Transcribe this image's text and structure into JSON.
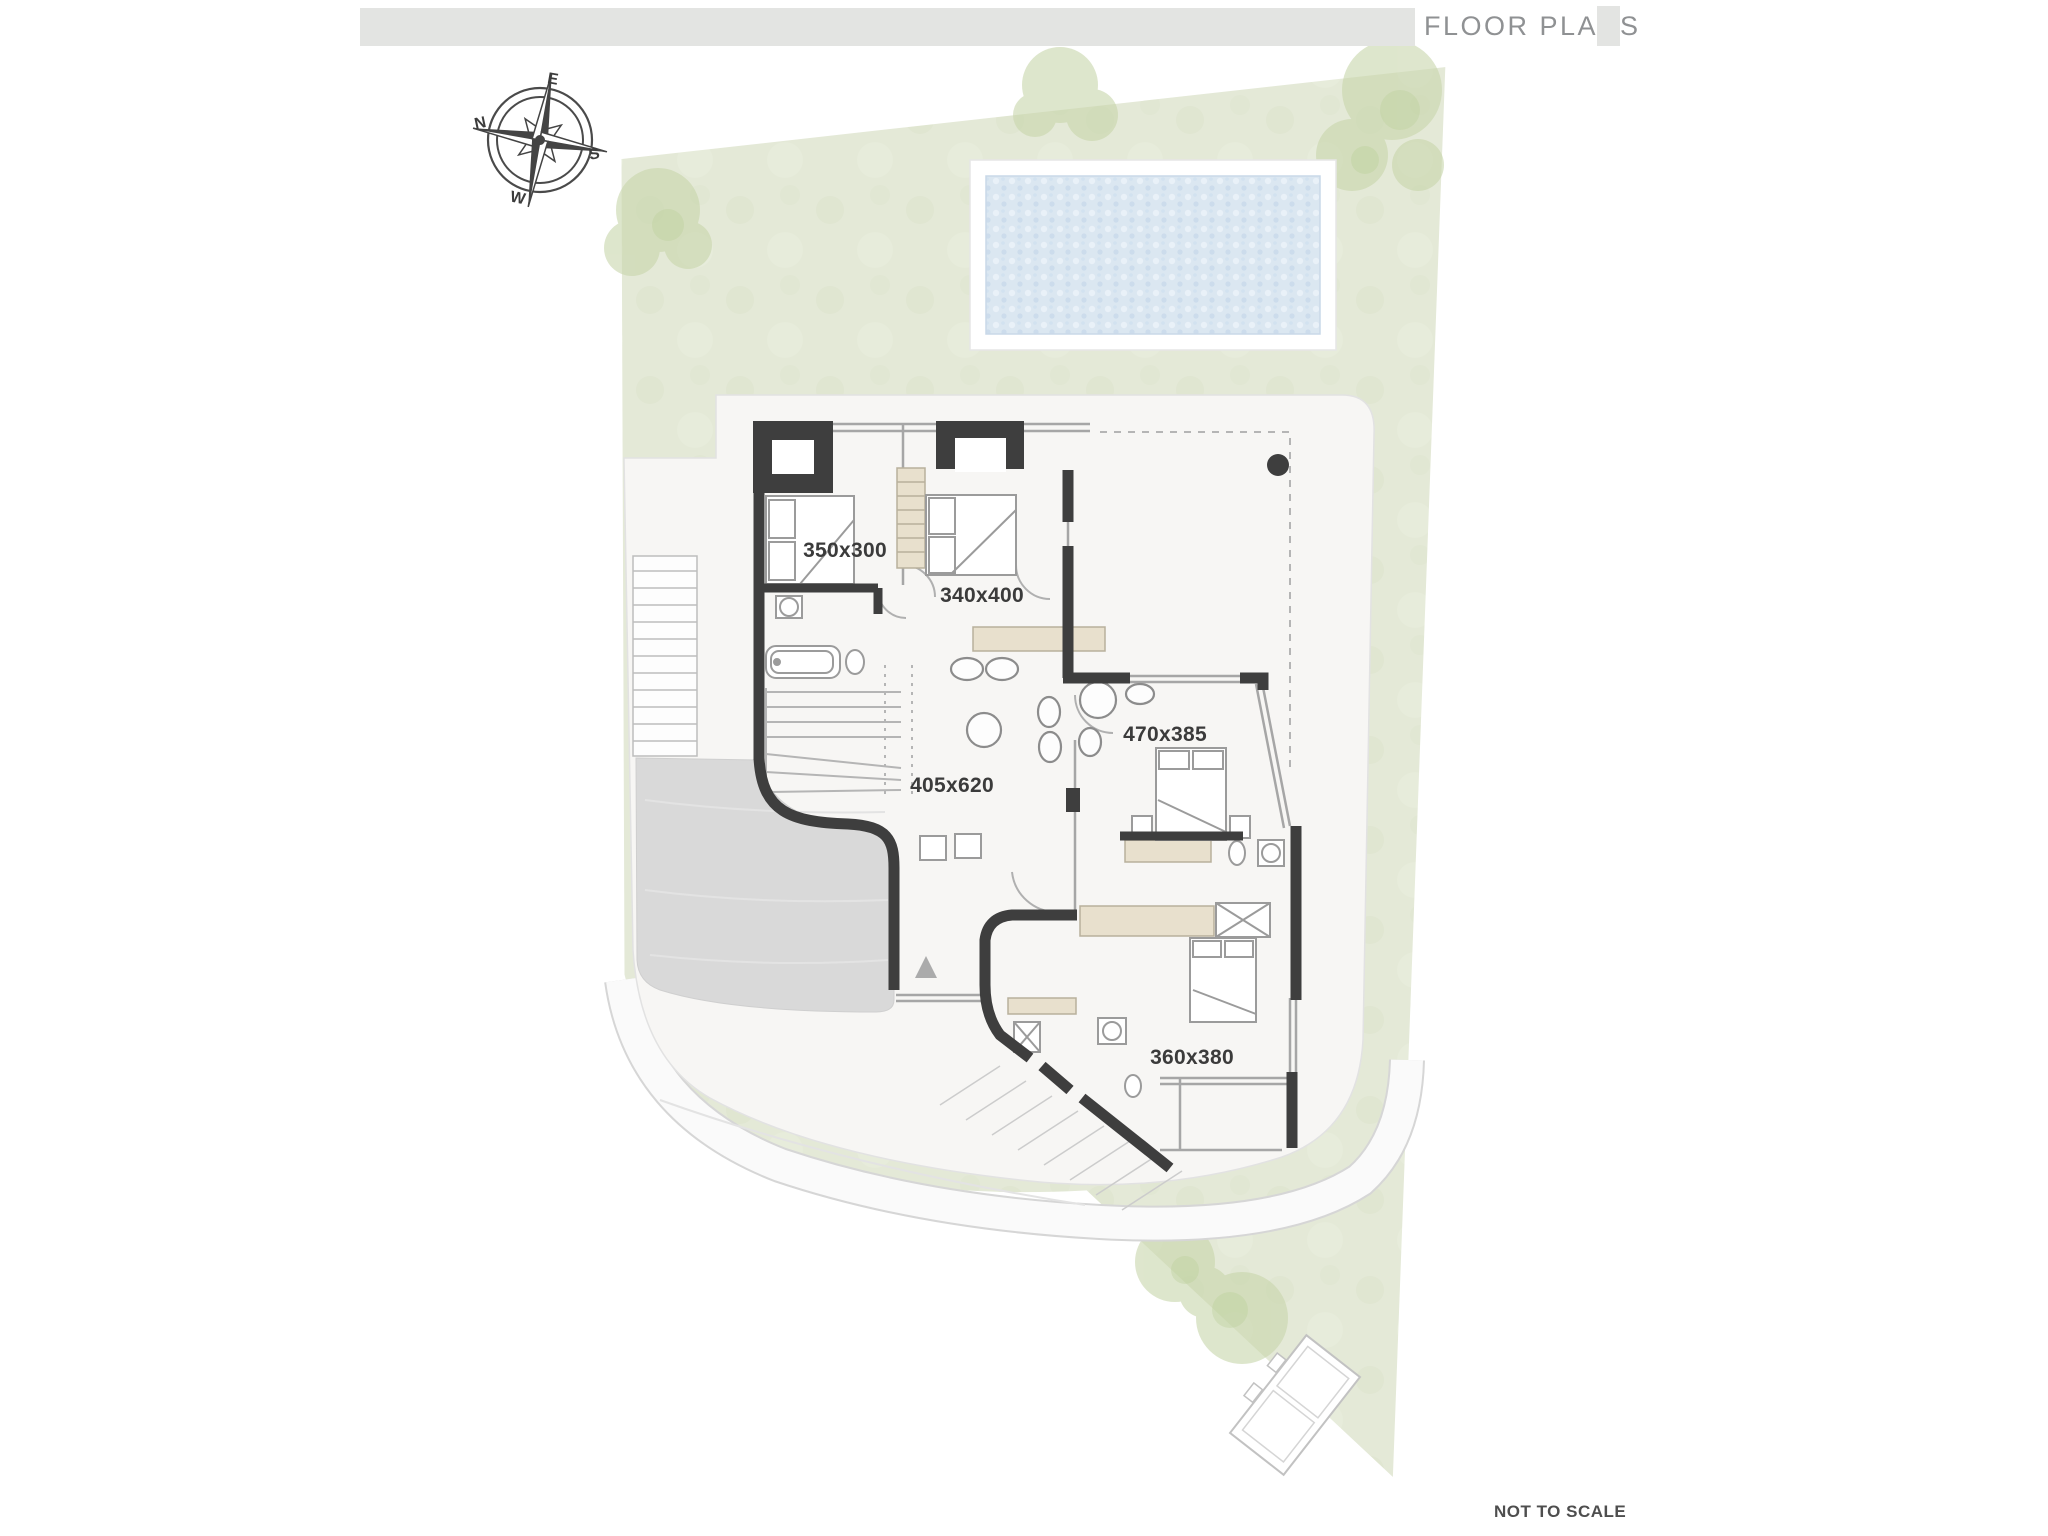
{
  "header": {
    "title": "FLOOR PLANS"
  },
  "footer": {
    "note": "NOT TO SCALE"
  },
  "compass": {
    "north": "N",
    "east": "E",
    "south": "S",
    "west": "W"
  },
  "plan": {
    "rooms": [
      {
        "id": "bedroom-1",
        "dimensions": "350x300"
      },
      {
        "id": "bedroom-2",
        "dimensions": "340x400"
      },
      {
        "id": "living-area",
        "dimensions": "405x620"
      },
      {
        "id": "bedroom-3",
        "dimensions": "470x385"
      },
      {
        "id": "bedroom-4",
        "dimensions": "360x380"
      }
    ],
    "colors": {
      "garden": "#e4e9d7",
      "pool_water": "#dbe7f1",
      "walls": "#3e3e3e",
      "terrace": "#d9d9d9",
      "furniture_tan": "#e8e0cd",
      "header_bar": "#e3e4e2",
      "north_red": "#d0382f"
    }
  }
}
